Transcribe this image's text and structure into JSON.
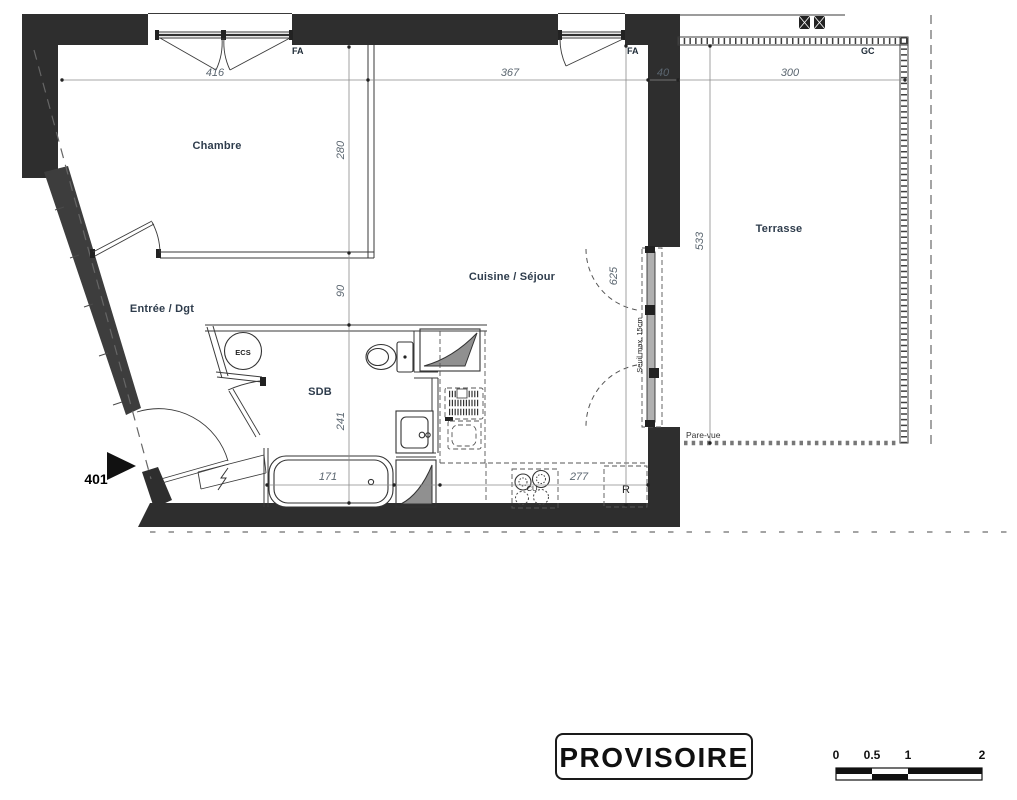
{
  "plan": {
    "unit_number": "401",
    "stamp": "PROVISOIRE",
    "rooms": {
      "chambre": "Chambre",
      "entree": "Entrée / Dgt",
      "sdb": "SDB",
      "cuisine_sejour": "Cuisine / Séjour",
      "terrasse": "Terrasse"
    },
    "equipment": {
      "water_heater": "ECS",
      "cooktop": "CU",
      "fridge": "R"
    },
    "openings": {
      "window_chambre": "FA",
      "window_sejour": "FA",
      "railing": "GC",
      "privacy_screen": "Pare-vue",
      "threshold_note": "Seuil max. 15cm"
    },
    "dimensions_cm": {
      "chambre_width": "416",
      "sejour_width": "367",
      "wall_thickness": "40",
      "terrasse_width": "300",
      "chambre_depth": "280",
      "corridor": "90",
      "sdb_depth": "241",
      "sejour_depth": "625",
      "terrasse_depth": "533",
      "bathtub": "171",
      "kitchen_counter": "277"
    },
    "scale_bar": {
      "t0": "0",
      "t05": "0.5",
      "t1": "1",
      "t2": "2"
    }
  }
}
